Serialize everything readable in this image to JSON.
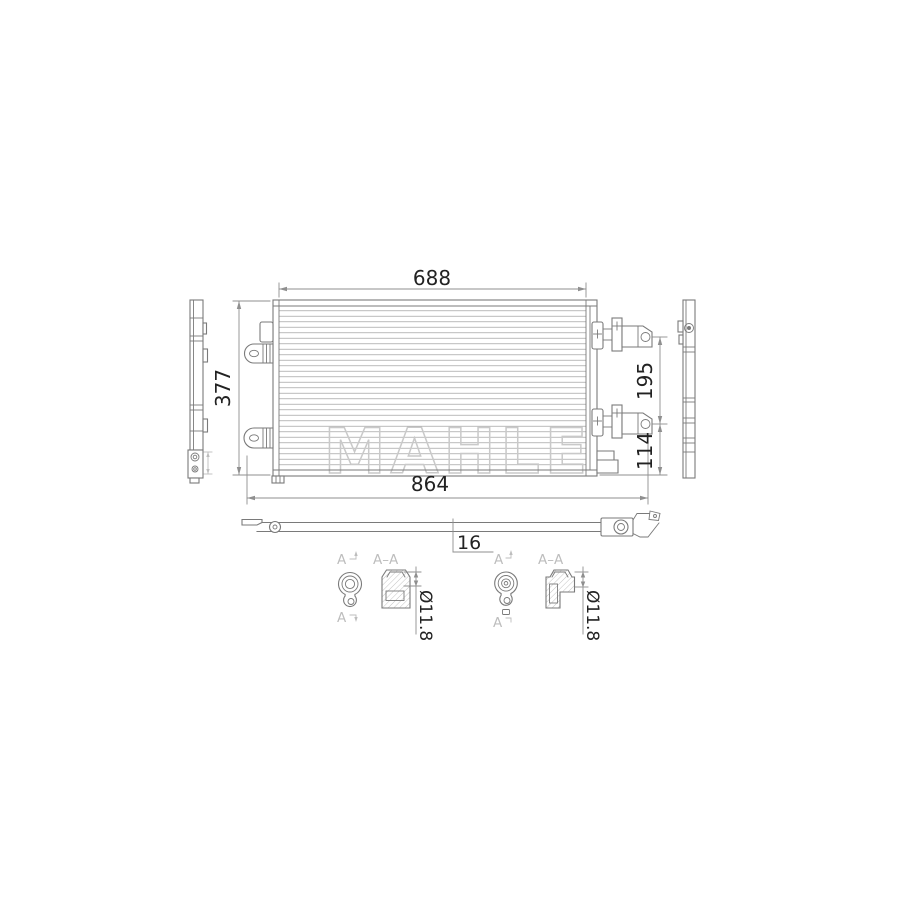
{
  "drawing": {
    "title": "condenser-technical-drawing",
    "watermark": "MAHLE",
    "dimensions": {
      "core_width": "688",
      "core_height": "377",
      "overall_width": "864",
      "upper_to_lower_port": "195",
      "lower_port_to_bottom": "114",
      "core_depth": "16"
    },
    "details": [
      {
        "cut_label_top": "A",
        "cut_label_bottom": "A",
        "section_label": "A–A",
        "port_diameter": "Ø11.8"
      },
      {
        "cut_label_top": "A",
        "cut_label_bottom": "A",
        "section_label": "A–A",
        "port_diameter": "Ø11.8"
      }
    ],
    "colors": {
      "line": "#7a7a7a",
      "fin": "#ababab",
      "dim": "#8f8f8f",
      "text": "#222222",
      "light": "#bdbdbd",
      "wm": "#c9c9c9",
      "hatch": "#b5b5b5",
      "bg": "#ffffff"
    }
  }
}
